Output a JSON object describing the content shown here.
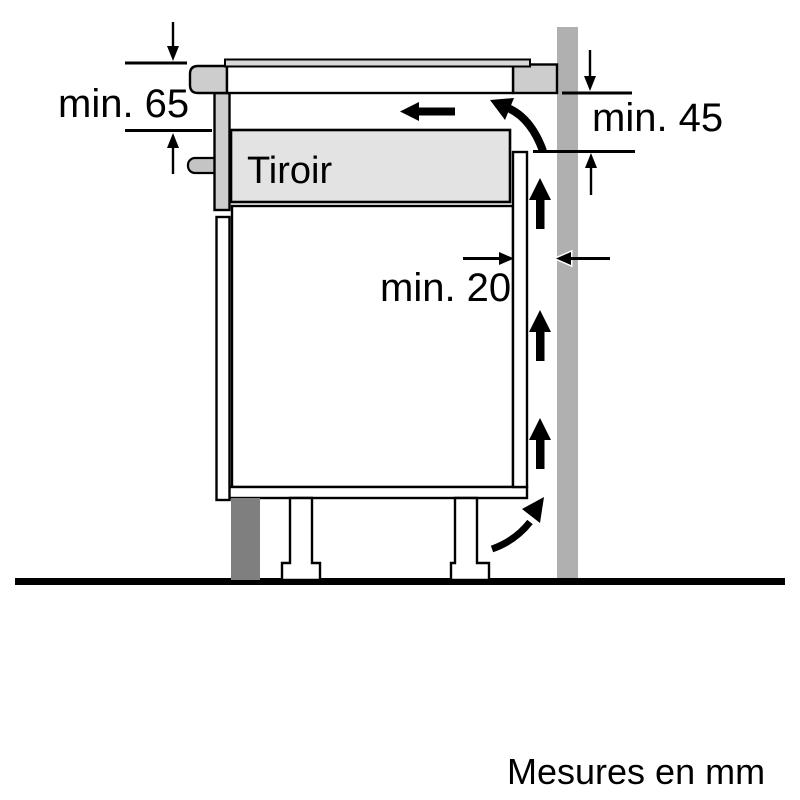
{
  "diagram": {
    "drawer_label": "Tiroir",
    "dimensions": {
      "worktop_to_drawer": "min. 65",
      "worktop_to_back_panel": "min. 45",
      "rear_gap": "min. 20"
    },
    "footer_note": "Mesures en mm"
  },
  "colors": {
    "background": "#ffffff",
    "line": "#000000",
    "wall": "#b0b0b0",
    "cabinet_panel": "#cdcdcd",
    "cooktop_trim": "#d9d9d9",
    "drawer_fill": "#e3e3e3",
    "handle": "#c4c4c4",
    "plinth": "#7f7f7f"
  }
}
